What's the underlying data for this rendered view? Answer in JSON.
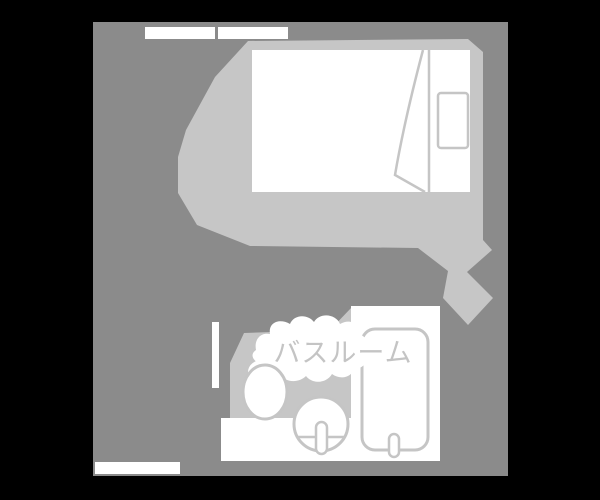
{
  "floorplan": {
    "bathroom_label": "バスルーム",
    "colors": {
      "background": "#000000",
      "room": "#8b8b8b",
      "carpet": "#c6c6c6",
      "white": "#ffffff",
      "outline": "#c5c5c5",
      "label": "#c4c4c4"
    }
  }
}
